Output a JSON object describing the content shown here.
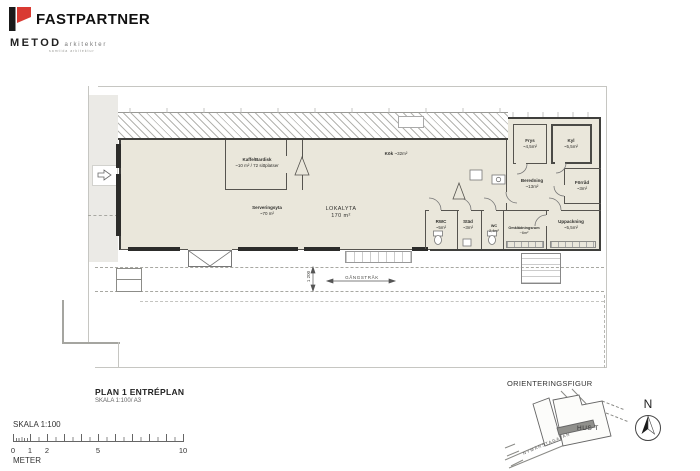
{
  "header": {
    "brand": "FASTPARTNER",
    "studio": "METOD",
    "studio_type": "arkitekter",
    "studio_tagline": "samtida arkitektur"
  },
  "plan": {
    "rooms": {
      "kaffe": {
        "name": "Kaffe/Bardisk",
        "info": "~10 m² / 72 sittplatser"
      },
      "kok": {
        "name": "Kök",
        "info": "~32m²"
      },
      "servering": {
        "name": "Serveringsyta",
        "info": "~70 m²"
      },
      "lokalyta": {
        "name": "LOKALYTA",
        "info": "170 m²"
      },
      "frys": {
        "name": "Frys",
        "info": "~4,5m²"
      },
      "kyl": {
        "name": "Kyl",
        "info": "~5,5m²"
      },
      "beredning": {
        "name": "Beredning",
        "info": "~13m²"
      },
      "forrad": {
        "name": "Förråd",
        "info": "~3m²"
      },
      "rwc": {
        "name": "RWC",
        "info": "~5m²"
      },
      "stad": {
        "name": "Städ",
        "info": "~3m²"
      },
      "wc": {
        "name": "WC",
        "info": "2,4m²"
      },
      "omklad": {
        "name": "Omklädningsrum",
        "info": "~6m²"
      },
      "uppack": {
        "name": "Uppackning",
        "info": "~5,5m²"
      }
    },
    "annotations": {
      "gangstrak": "GÅNGSTRÅK",
      "dim": "1 200"
    }
  },
  "titleblock": {
    "title": "PLAN 1 ENTRÉPLAN",
    "subtitle": "SKALA 1:100/ A3"
  },
  "scalebar": {
    "label": "SKALA 1:100",
    "unit": "METER",
    "ticks": [
      "0",
      "1",
      "2",
      "5",
      "10"
    ]
  },
  "orientation": {
    "title": "ORIENTERINGSFIGUR",
    "building": "HUS T",
    "street": "NYMÄRSTAGATAN",
    "north": "N"
  },
  "colors": {
    "accent_red": "#d93a32",
    "floor": "#eae7db",
    "wall": "#3f3f3c"
  }
}
